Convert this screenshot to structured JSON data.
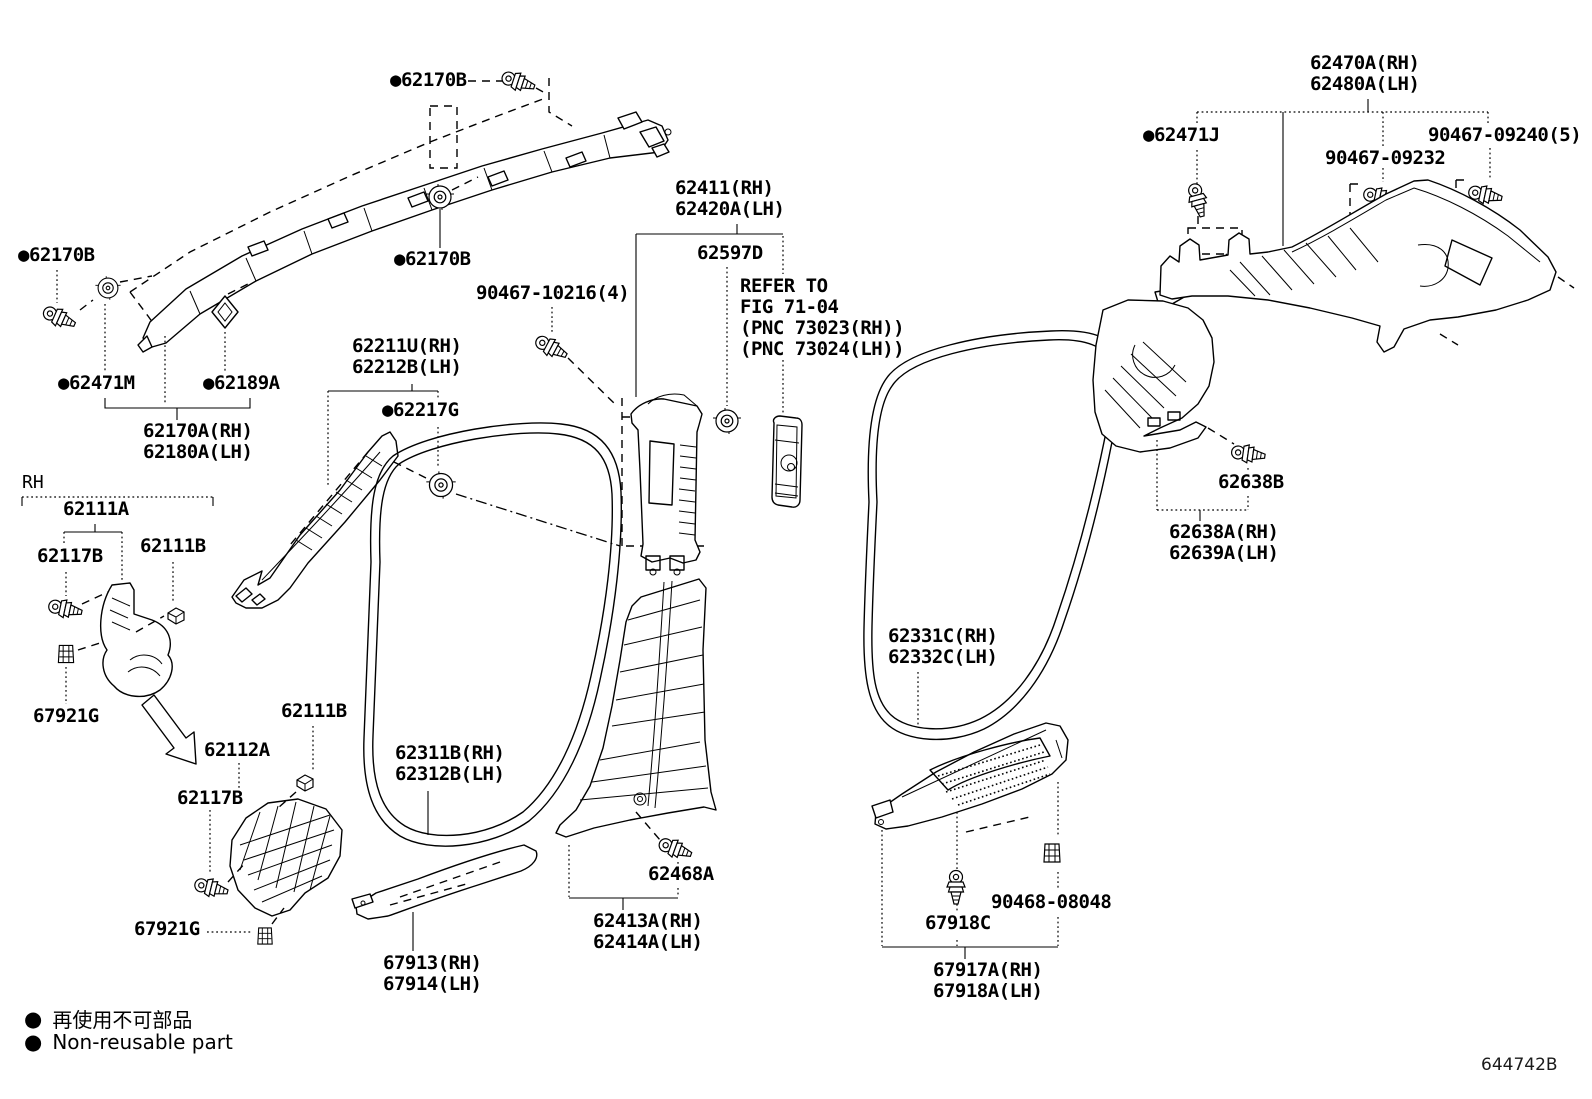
{
  "diagram": {
    "drawing_number": "644742B",
    "view_marker": "RH",
    "legend": [
      {
        "symbol": "●",
        "text": "再使用不可部品"
      },
      {
        "symbol": "●",
        "text": "Non-reusable part"
      }
    ],
    "labels": [
      {
        "id": "62170b-top",
        "type": "part",
        "non_reusable": true,
        "text": [
          "62170B"
        ],
        "x": 390,
        "y": 70
      },
      {
        "id": "62170b-left",
        "type": "part",
        "non_reusable": true,
        "text": [
          "62170B"
        ],
        "x": 18,
        "y": 245
      },
      {
        "id": "62471m",
        "type": "part",
        "non_reusable": true,
        "text": [
          "62471M"
        ],
        "x": 58,
        "y": 373
      },
      {
        "id": "62189a",
        "type": "part",
        "non_reusable": true,
        "text": [
          "62189A"
        ],
        "x": 203,
        "y": 373
      },
      {
        "id": "62170a",
        "type": "part",
        "non_reusable": false,
        "text": [
          "62170A(RH)",
          "62180A(LH)"
        ],
        "x": 143,
        "y": 421
      },
      {
        "id": "62111a",
        "type": "part",
        "non_reusable": false,
        "text": [
          "62111A"
        ],
        "x": 63,
        "y": 499
      },
      {
        "id": "62117b-1",
        "type": "part",
        "non_reusable": false,
        "text": [
          "62117B"
        ],
        "x": 37,
        "y": 546
      },
      {
        "id": "62111b-1",
        "type": "part",
        "non_reusable": false,
        "text": [
          "62111B"
        ],
        "x": 140,
        "y": 536
      },
      {
        "id": "67921g-1",
        "type": "part",
        "non_reusable": false,
        "text": [
          "67921G"
        ],
        "x": 33,
        "y": 706
      },
      {
        "id": "62111b-2",
        "type": "part",
        "non_reusable": false,
        "text": [
          "62111B"
        ],
        "x": 281,
        "y": 701
      },
      {
        "id": "62112a",
        "type": "part",
        "non_reusable": false,
        "text": [
          "62112A"
        ],
        "x": 204,
        "y": 740
      },
      {
        "id": "62117b-2",
        "type": "part",
        "non_reusable": false,
        "text": [
          "62117B"
        ],
        "x": 177,
        "y": 788
      },
      {
        "id": "67921g-2",
        "type": "part",
        "non_reusable": false,
        "text": [
          "67921G"
        ],
        "x": 134,
        "y": 919
      },
      {
        "id": "62211u",
        "type": "part",
        "non_reusable": false,
        "text": [
          "62211U(RH)",
          "62212B(LH)"
        ],
        "x": 352,
        "y": 336
      },
      {
        "id": "62217g",
        "type": "part",
        "non_reusable": true,
        "text": [
          "62217G"
        ],
        "x": 382,
        "y": 400
      },
      {
        "id": "90467-10216",
        "type": "part",
        "non_reusable": false,
        "text": [
          "90467-10216(4)"
        ],
        "x": 476,
        "y": 283
      },
      {
        "id": "62170b-mid",
        "type": "part",
        "non_reusable": true,
        "text": [
          "62170B"
        ],
        "x": 394,
        "y": 249
      },
      {
        "id": "62411",
        "type": "part",
        "non_reusable": false,
        "text": [
          "62411(RH)",
          "62420A(LH)"
        ],
        "x": 675,
        "y": 178
      },
      {
        "id": "62597d",
        "type": "part",
        "non_reusable": false,
        "text": [
          "62597D"
        ],
        "x": 697,
        "y": 243
      },
      {
        "id": "refer-note",
        "type": "note",
        "non_reusable": false,
        "text": [
          "REFER TO",
          "FIG 71-04",
          "(PNC 73023(RH))",
          "(PNC 73024(LH))"
        ],
        "x": 740,
        "y": 276
      },
      {
        "id": "62311b",
        "type": "part",
        "non_reusable": false,
        "text": [
          "62311B(RH)",
          "62312B(LH)"
        ],
        "x": 395,
        "y": 743
      },
      {
        "id": "62468a",
        "type": "part",
        "non_reusable": false,
        "text": [
          "62468A"
        ],
        "x": 648,
        "y": 864
      },
      {
        "id": "62413a",
        "type": "part",
        "non_reusable": false,
        "text": [
          "62413A(RH)",
          "62414A(LH)"
        ],
        "x": 593,
        "y": 911
      },
      {
        "id": "67913",
        "type": "part",
        "non_reusable": false,
        "text": [
          "67913(RH)",
          "67914(LH)"
        ],
        "x": 383,
        "y": 953
      },
      {
        "id": "62331c",
        "type": "part",
        "non_reusable": false,
        "text": [
          "62331C(RH)",
          "62332C(LH)"
        ],
        "x": 888,
        "y": 626
      },
      {
        "id": "62470a",
        "type": "part",
        "non_reusable": false,
        "text": [
          "62470A(RH)",
          "62480A(LH)"
        ],
        "x": 1310,
        "y": 53
      },
      {
        "id": "62471j",
        "type": "part",
        "non_reusable": true,
        "text": [
          "62471J"
        ],
        "x": 1143,
        "y": 125
      },
      {
        "id": "90467-09232",
        "type": "part",
        "non_reusable": false,
        "text": [
          "90467-09232"
        ],
        "x": 1325,
        "y": 148
      },
      {
        "id": "90467-09240",
        "type": "part",
        "non_reusable": false,
        "text": [
          "90467-09240(5)"
        ],
        "x": 1428,
        "y": 125
      },
      {
        "id": "62638b",
        "type": "part",
        "non_reusable": false,
        "text": [
          "62638B"
        ],
        "x": 1218,
        "y": 472
      },
      {
        "id": "62638a",
        "type": "part",
        "non_reusable": false,
        "text": [
          "62638A(RH)",
          "62639A(LH)"
        ],
        "x": 1169,
        "y": 522
      },
      {
        "id": "90468-08048",
        "type": "part",
        "non_reusable": false,
        "text": [
          "90468-08048"
        ],
        "x": 991,
        "y": 892
      },
      {
        "id": "67918c",
        "type": "part",
        "non_reusable": false,
        "text": [
          "67918C"
        ],
        "x": 925,
        "y": 913
      },
      {
        "id": "67917a",
        "type": "part",
        "non_reusable": false,
        "text": [
          "67917A(RH)",
          "67918A(LH)"
        ],
        "x": 933,
        "y": 960
      }
    ]
  }
}
